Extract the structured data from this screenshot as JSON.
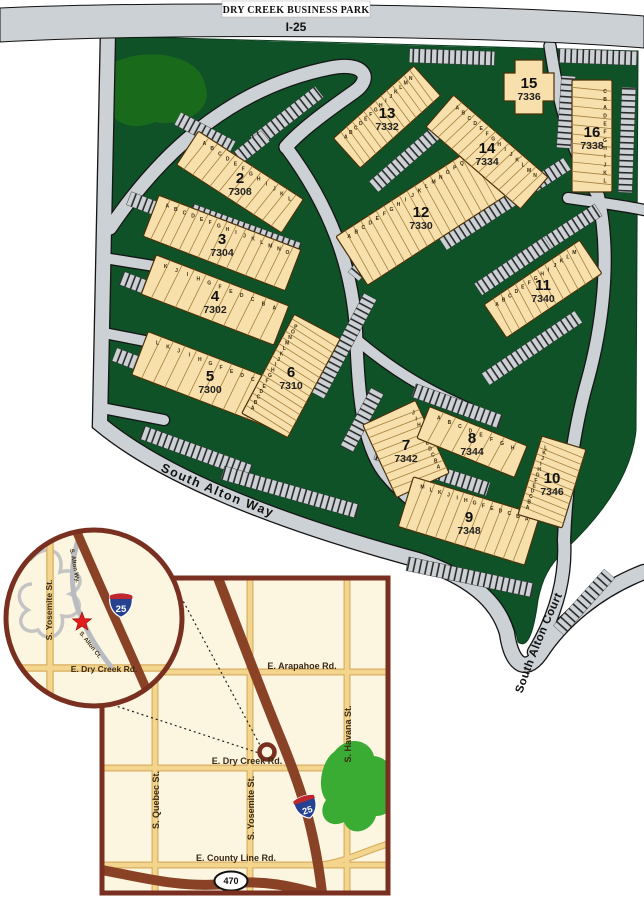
{
  "title_banner": {
    "park_name": "DRY CREEK BUSINESS PARK",
    "highway_label": "I-25"
  },
  "colors": {
    "road_gray": "#ccd1d5",
    "road_outline": "#151515",
    "park_green": "#105228",
    "tree_green": "#1a6a1c",
    "building_fill": "#f7e0ab",
    "building_stroke": "#4a3008",
    "divider": "#a5803f",
    "map_cream": "#fcf5e0",
    "map_border_brown": "#7a3020",
    "tan_road": "#f3d58e",
    "tan_road_edge": "#d8af62",
    "highway_brown": "#8a4226",
    "map_green": "#3aac34",
    "shield_blue": "#26418f",
    "shield_red": "#c0272d",
    "star_red": "#e21a1a"
  },
  "site_plan": {
    "road_labels": [
      {
        "text": "South Alton Way",
        "path": "M150,466 C240,508 320,536 408,562",
        "size": 12.5,
        "spacing": 1.5
      },
      {
        "text": "South Alton Court",
        "path": "M520,700 C538,648 554,610 584,550",
        "size": 11.5,
        "spacing": 0.5
      }
    ],
    "roads": [
      {
        "d": "M108,32 L100,424 C160,474 270,520 418,560 C468,577 497,599 507,633 C511,662 524,676 540,654 C562,620 598,590 644,572",
        "w": 14
      },
      {
        "d": "M110,228 C168,142 240,86 330,68 C364,61 374,78 354,92 C324,113 300,131 286,147",
        "w": 13
      },
      {
        "d": "M286,147 C330,206 352,266 356,330 C358,392 362,442 384,472 C404,498 436,520 470,542",
        "w": 12
      },
      {
        "d": "M104,258 L154,266",
        "w": 10
      },
      {
        "d": "M104,333 L150,342",
        "w": 10
      },
      {
        "d": "M102,408 L164,420",
        "w": 10
      },
      {
        "d": "M550,46 C558,100 570,150 598,196",
        "w": 11
      },
      {
        "d": "M598,196 C612,258 602,330 586,386 C574,430 566,486 564,540",
        "w": 12
      },
      {
        "d": "M564,540 C566,574 558,612 534,652",
        "w": 12
      },
      {
        "d": "M568,198 C602,203 626,206 644,210",
        "w": 10
      },
      {
        "d": "M357,340 C395,372 430,392 468,408",
        "w": 10
      }
    ],
    "parking": [
      [
        452,
        57,
        85,
        2
      ],
      [
        598,
        57,
        78,
        2
      ],
      [
        287,
        117,
        82,
        -38
      ],
      [
        245,
        152,
        52,
        -38
      ],
      [
        205,
        133,
        62,
        28
      ],
      [
        245,
        230,
        115,
        20
      ],
      [
        170,
        214,
        88,
        21
      ],
      [
        158,
        292,
        78,
        21
      ],
      [
        150,
        368,
        76,
        21
      ],
      [
        196,
        452,
        115,
        20
      ],
      [
        290,
        492,
        140,
        16
      ],
      [
        344,
        346,
        112,
        -62
      ],
      [
        362,
        420,
        66,
        -62
      ],
      [
        416,
        150,
        112,
        -41
      ],
      [
        505,
        204,
        148,
        -33
      ],
      [
        558,
        236,
        96,
        -33
      ],
      [
        566,
        112,
        72,
        -86
      ],
      [
        627,
        140,
        105,
        -88
      ],
      [
        513,
        266,
        84,
        -34
      ],
      [
        532,
        348,
        112,
        -34
      ],
      [
        457,
        406,
        92,
        20
      ],
      [
        432,
        471,
        118,
        18
      ],
      [
        470,
        577,
        128,
        12
      ],
      [
        584,
        602,
        76,
        -48
      ],
      [
        374,
        252,
        64,
        -50
      ]
    ],
    "green_path": "M106,36 C290,42 470,47 638,51 L636,430 C632,474 602,515 566,549 C548,566 542,580 538,600 C534,630 528,650 518,642 C510,600 480,578 420,560 C268,518 156,472 102,424 Z",
    "tree_path": "M120,60 C150,48 200,55 205,85 C215,108 185,128 155,122 C125,135 100,115 112,92 C105,72 112,62 120,60 Z",
    "buildings": [
      {
        "num": "2",
        "addr": "7308",
        "cx": 240,
        "cy": 182,
        "w": 125,
        "h": 40,
        "rot": 33,
        "units": [
          "A",
          "B",
          "C",
          "D",
          "E",
          "F",
          "G",
          "H",
          "I",
          "J",
          "K",
          "L"
        ]
      },
      {
        "num": "3",
        "addr": "7304",
        "cx": 222,
        "cy": 243,
        "w": 152,
        "h": 44,
        "rot": 21,
        "units": [
          "A",
          "B",
          "C",
          "D",
          "E",
          "F",
          "G",
          "H",
          "I",
          "J",
          "K",
          "L",
          "M",
          "N",
          "O"
        ]
      },
      {
        "num": "4",
        "addr": "7302",
        "cx": 215,
        "cy": 300,
        "w": 142,
        "h": 42,
        "rot": 21,
        "units": [
          "K",
          "J",
          "I",
          "H",
          "G",
          "F",
          "E",
          "D",
          "C",
          "B",
          "A"
        ]
      },
      {
        "num": "5",
        "addr": "7300",
        "cx": 210,
        "cy": 380,
        "w": 150,
        "h": 46,
        "rot": 21,
        "units": [
          "L",
          "K",
          "J",
          "I",
          "H",
          "G",
          "F",
          "E",
          "D",
          "C",
          "B",
          "A"
        ]
      },
      {
        "num": "6",
        "addr": "7310",
        "cx": 291,
        "cy": 376,
        "w": 112,
        "h": 52,
        "rot": -62,
        "units": [
          "A",
          "B",
          "C",
          "D",
          "E",
          "F",
          "G",
          "H",
          "I",
          "J",
          "K",
          "L",
          "M",
          "N",
          "O",
          "P"
        ]
      },
      {
        "num": "7",
        "addr": "7342",
        "cx": 406,
        "cy": 449,
        "w": 80,
        "h": 58,
        "rot": 65,
        "units": [
          "J",
          "I",
          "H",
          "G",
          "F",
          "E",
          "D",
          "C",
          "B",
          "A"
        ]
      },
      {
        "num": "8",
        "addr": "7344",
        "cx": 472,
        "cy": 442,
        "w": 105,
        "h": 34,
        "rot": 22,
        "units": [
          "A",
          "B",
          "C",
          "D",
          "E",
          "F",
          "G",
          "H"
        ]
      },
      {
        "num": "9",
        "addr": "7348",
        "cx": 469,
        "cy": 521,
        "w": 132,
        "h": 52,
        "rot": 17,
        "units": [
          "M",
          "L",
          "K",
          "J",
          "I",
          "H",
          "G",
          "F",
          "E",
          "D",
          "C",
          "B",
          "A"
        ]
      },
      {
        "num": "10",
        "addr": "7346",
        "cx": 552,
        "cy": 482,
        "w": 82,
        "h": 46,
        "rot": -73,
        "units": [
          "A",
          "B",
          "C",
          "D",
          "E",
          "F",
          "G",
          "H",
          "I",
          "J",
          "K",
          "L"
        ]
      },
      {
        "num": "11",
        "addr": "7340",
        "cx": 543,
        "cy": 289,
        "w": 115,
        "h": 40,
        "rot": -34,
        "units": [
          "A",
          "B",
          "C",
          "D",
          "E",
          "F",
          "G",
          "H",
          "I",
          "J",
          "K",
          "L",
          "M"
        ]
      },
      {
        "num": "12",
        "addr": "7330",
        "cx": 421,
        "cy": 216,
        "w": 165,
        "h": 58,
        "rot": -33,
        "units": [
          "A",
          "B",
          "C",
          "D",
          "E",
          "F",
          "G",
          "H",
          "I",
          "J",
          "K",
          "L",
          "M",
          "N",
          "O",
          "P",
          "Q",
          "R"
        ]
      },
      {
        "num": "13",
        "addr": "7332",
        "cx": 387,
        "cy": 117,
        "w": 108,
        "h": 40,
        "rot": -42,
        "units": [
          "A",
          "B",
          "C",
          "D",
          "E",
          "F",
          "G",
          "H",
          "I",
          "J",
          "K",
          "L",
          "M",
          "N"
        ]
      },
      {
        "num": "14",
        "addr": "7334",
        "cx": 487,
        "cy": 152,
        "w": 125,
        "h": 42,
        "rot": 41,
        "units": [
          "A",
          "B",
          "C",
          "D",
          "E",
          "F",
          "G",
          "H",
          "I",
          "J",
          "K",
          "L",
          "M",
          "N"
        ]
      },
      {
        "num": "15",
        "addr": "7336",
        "cx": 529,
        "cy": 87,
        "w": 50,
        "h": 54,
        "rot": 0,
        "shape": "cross",
        "units": []
      },
      {
        "num": "16",
        "addr": "7338",
        "cx": 592,
        "cy": 136,
        "w": 112,
        "h": 40,
        "rot": 90,
        "units": [
          "C",
          "B",
          "A",
          "D",
          "E",
          "F",
          "G",
          "H",
          "I",
          "J",
          "K",
          "L"
        ]
      }
    ]
  },
  "inset_circle": {
    "cx": 94,
    "cy": 618,
    "r": 88,
    "minor_road": "M30,560 C45,542 66,550 60,572 C80,566 88,585 70,594 C86,600 80,620 62,616 C66,636 46,644 38,630 C22,636 14,618 28,610 C14,602 18,584 32,584",
    "loop_road": "M80,534 C70,562 70,590 79,612 C86,630 96,648 112,668",
    "tan_roads": [
      "M50,532 L50,704",
      "M8,668 L180,668"
    ],
    "highway": {
      "d": "M76,530 C100,586 124,638 152,702",
      "w": 9
    },
    "labels": [
      {
        "t": "S. Yosemite St.",
        "x": 52,
        "y": 610,
        "r": -90,
        "s": 8.5
      },
      {
        "t": "E. Dry Creek Rd.",
        "x": 104,
        "y": 672,
        "r": 0,
        "s": 8.5
      },
      {
        "t": "S. Alton Wy.",
        "x": 73,
        "y": 566,
        "r": 80,
        "s": 6
      },
      {
        "t": "S. Alton Ct.",
        "x": 89,
        "y": 646,
        "r": 52,
        "s": 6
      }
    ],
    "shield": {
      "x": 121,
      "y": 604,
      "t": "25"
    },
    "star": {
      "x": 82,
      "y": 622,
      "r": 10
    }
  },
  "street_map": {
    "x": 102,
    "y": 578,
    "w": 286,
    "h": 315,
    "tan_roads": [
      "M155,578 L155,893",
      "M250,578 L250,893",
      "M347,578 L347,893",
      "M102,672 L388,672",
      "M102,768 L388,768",
      "M102,865 L388,865",
      "M320,865 C345,862 362,852 388,844"
    ],
    "highways": [
      {
        "d": "M218,578 C242,640 260,688 278,732 C298,780 314,824 322,893",
        "w": 10
      },
      {
        "d": "M102,870 C140,877 180,888 225,884 C262,879 292,886 330,897",
        "w": 10
      }
    ],
    "labels": [
      {
        "t": "E. Arapahoe Rd.",
        "x": 302,
        "y": 669,
        "r": 0,
        "s": 9
      },
      {
        "t": "E. Dry Creek Rd.",
        "x": 247,
        "y": 764,
        "r": 0,
        "s": 9
      },
      {
        "t": "E. County Line Rd.",
        "x": 236,
        "y": 861,
        "r": 0,
        "s": 9
      },
      {
        "t": "S. Quebec St.",
        "x": 159,
        "y": 800,
        "r": -90,
        "s": 9
      },
      {
        "t": "S. Yosemite St.",
        "x": 254,
        "y": 808,
        "r": -90,
        "s": 9
      },
      {
        "t": "S. Havana St.",
        "x": 351,
        "y": 734,
        "r": -90,
        "s": 9
      }
    ],
    "interstate_shield": {
      "x": 306,
      "y": 806,
      "t": "25",
      "rot": -18
    },
    "oval_shield": {
      "x": 231,
      "y": 881,
      "t": "470"
    },
    "marker": {
      "x": 267,
      "y": 752,
      "r": 7.5
    },
    "green_blob": "M334,752 C348,734 370,740 374,756 C392,758 396,776 386,788 C396,800 392,816 376,816 C372,832 350,838 344,822 C328,830 316,814 326,800 C316,788 322,760 334,752 Z",
    "dotted": [
      "M181,597 L261,747",
      "M113,705 L259,753"
    ]
  }
}
